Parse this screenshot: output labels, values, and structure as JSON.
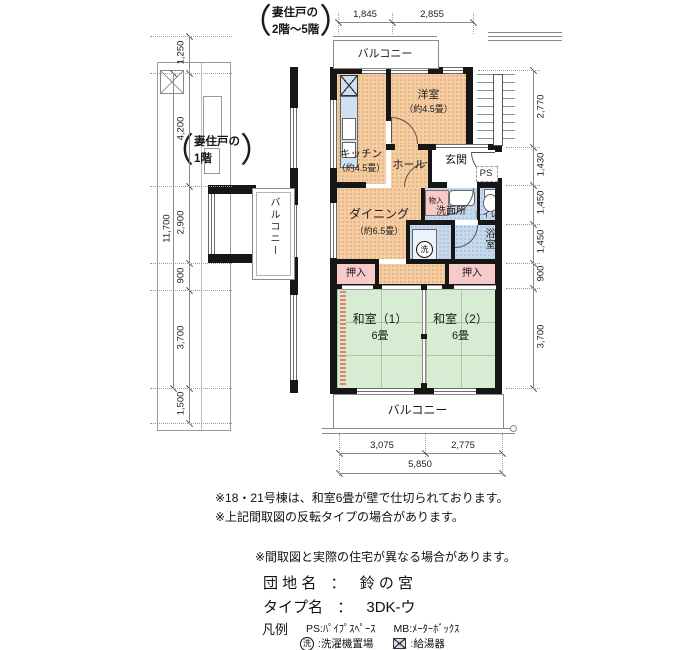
{
  "side_notes": {
    "paren_open": "（",
    "paren_close": "）",
    "upper": {
      "l1": "妻住戸の",
      "l2": "2階～5階"
    },
    "lower": {
      "l1": "妻住戸の",
      "l2": "1階"
    }
  },
  "rooms": {
    "yoshitsu": {
      "name": "洋室",
      "size": "（約4.5畳）"
    },
    "kitchen": {
      "name": "キッチン",
      "size": "（約4.5畳）"
    },
    "hall": {
      "name": "ホール"
    },
    "genkan": {
      "name": "玄関"
    },
    "ps": "PS",
    "dining": {
      "name": "ダイニング",
      "size": "（約6.5畳）"
    },
    "monoire": {
      "name": "物入"
    },
    "senmenjo": {
      "name": "洗面所"
    },
    "toilet": {
      "name": "トイレ"
    },
    "bath": {
      "name": "浴室"
    },
    "oshiire": {
      "name": "押入"
    },
    "washitsu1": {
      "name": "和室（1）",
      "size": "6畳"
    },
    "washitsu2": {
      "name": "和室（2）",
      "size": "6畳"
    },
    "balcony": {
      "name": "バルコニー"
    },
    "washer_symbol": "洗"
  },
  "dimensions": {
    "top": {
      "d1": "1,845",
      "d2": "2,855"
    },
    "bottom": {
      "d1": "3,075",
      "d2": "2,775",
      "total": "5,850"
    },
    "left": {
      "d1": "1,250",
      "d2": "4,200",
      "d3": "2,900",
      "d4": "900",
      "d5": "3,700",
      "d6": "1,500",
      "total": "11,700"
    },
    "right": {
      "d1": "2,770",
      "d2": "1,430",
      "d3": "1,450",
      "d4": "1,450",
      "d5": "900",
      "d6": "3,700"
    }
  },
  "notes": {
    "note1": "※18・21号棟は、和室6畳が壁で仕切られております。",
    "note2": "※上記間取図の反転タイプの場合があります。",
    "note3": "※間取図と実際の住宅が異なる場合があります。"
  },
  "property": {
    "estate_label": "団 地 名",
    "separator": "：",
    "estate_value": "鈴 の 宮",
    "type_label": "タイプ名",
    "type_value": "3DK-ウ"
  },
  "legend": {
    "title": "凡例",
    "ps": "PS:ﾊﾟｲﾌﾟｽﾍﾟｰｽ",
    "mb": "MB:ﾒｰﾀｰﾎﾞｯｸｽ",
    "washer_symbol": "洗",
    "washer_label": ":洗濯機置場",
    "heater_label": ":給湯器"
  },
  "colors": {
    "room_orange": "#f5cda3",
    "tatami_green": "#d8ebd3",
    "wet_blue": "#c7d9ec",
    "closet_pink": "#f7c9c9",
    "wall": "#161616"
  }
}
